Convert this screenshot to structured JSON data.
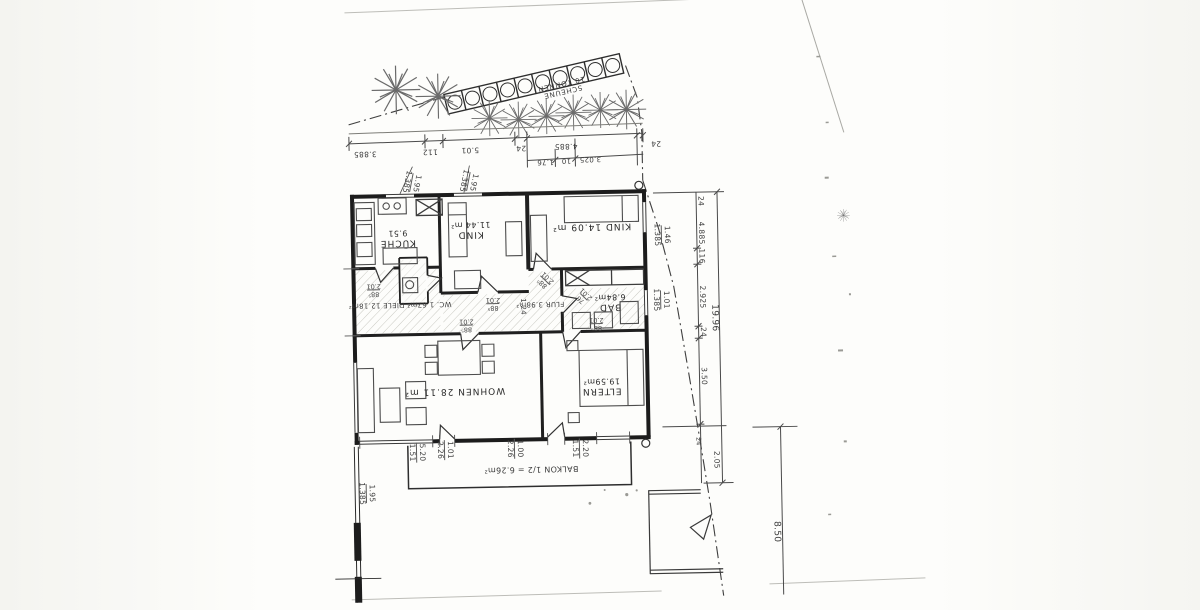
{
  "document": {
    "kind": "Scanned architectural floor plan of an apartment, drawn rotated 180 degrees (all lettering appears upside-down)",
    "language": "German"
  },
  "shed": {
    "name_line": "SCHEUNE",
    "capacity_line": "10 TONNEN",
    "bay_count": "10"
  },
  "rooms": {
    "kueche_name": "KÜCHE",
    "kueche_area": "9.51",
    "kind1_name": "KIND",
    "kind1_area": "11.44 m²",
    "kind2_label": "KIND 14.09 m²",
    "wc_diele_label": "WC. 1.67m²  DIELE 12.18m²",
    "flur_label": "FLUR 3.98m²",
    "bad_name": "BAD",
    "bad_area": "6.84m²",
    "wohnen_label": "WOHNEN 28.11 m²",
    "eltern_name": "ELTERN",
    "eltern_area": "19.59m²",
    "balkon_label": "BALKON 1/2 = 6.26m²"
  },
  "dims": {
    "top_chain": [
      "3.885",
      "112",
      "5.01",
      "24",
      "4.885",
      "24"
    ],
    "top_sub": [
      "1.76",
      "10",
      "3.025"
    ],
    "right_chain": [
      "24",
      "4.885",
      "116",
      "2.925",
      "24",
      "3.50"
    ],
    "right_total": "19.96",
    "right_lower_24": "24",
    "right_lower_205": "2.05",
    "site_depth": "8.50",
    "south_pairs": [
      [
        "5.20",
        "1.51"
      ],
      [
        "1.01",
        "2.26"
      ],
      [
        "1.00",
        "2.26"
      ],
      [
        "2.20",
        "1.51"
      ]
    ],
    "north_window_pairs": [
      [
        "1.95",
        "1.385"
      ],
      [
        "1.95",
        "1.385"
      ]
    ],
    "east_window_pairs": [
      [
        "1.46",
        "1.385"
      ],
      [
        "1.01",
        "1.385"
      ]
    ],
    "west_window_pair": [
      "1.95",
      "1.385"
    ],
    "hall_width": "1.24"
  },
  "doors": [
    {
      "w": "88⁵",
      "h": "2.01"
    },
    {
      "w": "88⁵",
      "h": "2.01"
    },
    {
      "w": "88⁵",
      "h": "2.01"
    },
    {
      "w": "88⁵",
      "h": "2.01"
    },
    {
      "w": "76",
      "h": "2.01"
    },
    {
      "w": "88⁵",
      "h": "2.01"
    }
  ]
}
